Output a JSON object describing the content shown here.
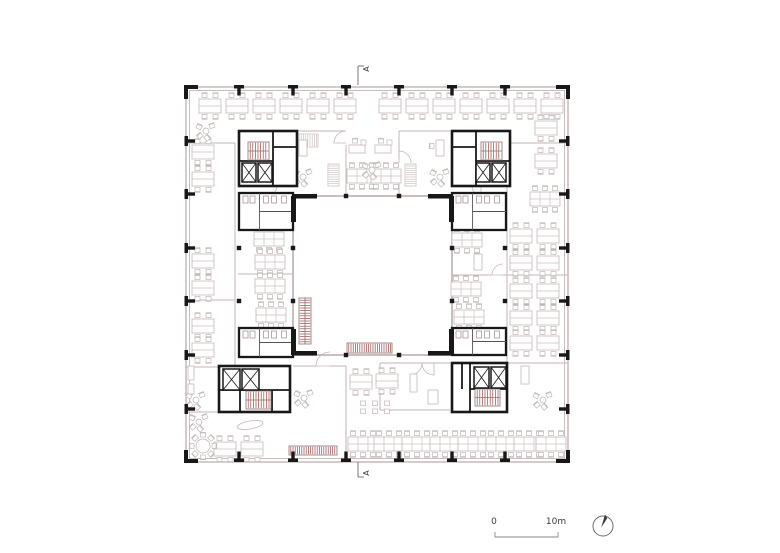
{
  "labels": {
    "section_marker": "A",
    "scale_start": "0",
    "scale_end": "10m"
  },
  "colors": {
    "black": "#181818",
    "wall": "#b3a0a0",
    "wallLight": "#c6b6b6",
    "furn": "#ccc1c1",
    "furn2": "#c3b7b7",
    "red": "#9c4a4a",
    "text": "#3a3a3a",
    "marker": "#6a6a6a"
  },
  "plan": {
    "outer": [
      186,
      87,
      382,
      375
    ],
    "outer_inner": [
      189.5,
      90.5,
      375,
      368
    ],
    "courtyard": [
      293,
      196,
      159,
      159
    ],
    "partitions": [
      [
        186,
        143,
        235,
        143
      ],
      [
        235,
        143,
        235,
        367
      ],
      [
        186,
        300,
        235,
        300
      ],
      [
        186,
        367,
        219,
        367
      ],
      [
        186,
        412,
        219,
        412
      ],
      [
        293,
        366,
        316,
        366
      ],
      [
        330,
        366,
        346,
        366
      ],
      [
        346,
        366,
        346,
        462
      ],
      [
        380,
        363,
        380,
        410
      ],
      [
        380,
        410,
        450,
        410
      ],
      [
        380,
        363,
        450,
        363
      ],
      [
        507,
        186,
        507,
        363
      ],
      [
        507,
        143,
        568,
        143
      ],
      [
        507,
        363,
        568,
        363
      ],
      [
        452,
        275,
        492,
        275
      ],
      [
        503,
        275,
        568,
        275
      ],
      [
        238,
        274,
        293,
        274
      ],
      [
        297,
        131,
        346,
        131
      ],
      [
        346,
        145,
        346,
        196
      ],
      [
        399,
        131,
        450,
        131
      ],
      [
        399,
        131,
        399,
        159
      ],
      [
        399,
        170,
        399,
        196
      ]
    ],
    "doors": [
      [
        346,
        143,
        12,
        180,
        270
      ],
      [
        399,
        163,
        12,
        270,
        360
      ],
      [
        330,
        366,
        14,
        180,
        270
      ],
      [
        503,
        275,
        11,
        180,
        270
      ],
      [
        268,
        186,
        9,
        0,
        90
      ],
      [
        481,
        186,
        9,
        90,
        180
      ],
      [
        410,
        363,
        12,
        0,
        90
      ],
      [
        434,
        363,
        12,
        90,
        180
      ],
      [
        262,
        230,
        8,
        0,
        90
      ],
      [
        475,
        230,
        8,
        90,
        180
      ],
      [
        262,
        328,
        8,
        270,
        360
      ],
      [
        475,
        328,
        8,
        180,
        270
      ]
    ],
    "grid_top_x": [
      239,
      293,
      346,
      399,
      452,
      505
    ],
    "grid_side_y": [
      141,
      194,
      248,
      301,
      355,
      409
    ],
    "courtyard_cols": [
      [
        346,
        196
      ],
      [
        399,
        196
      ],
      [
        346,
        355
      ],
      [
        399,
        355
      ],
      [
        293,
        248
      ],
      [
        293,
        301
      ],
      [
        452,
        248
      ],
      [
        452,
        301
      ]
    ],
    "interior_cols": [
      [
        239,
        248
      ],
      [
        239,
        301
      ],
      [
        505,
        248
      ],
      [
        505,
        301
      ]
    ],
    "stubs": [
      [
        291,
        196,
        5,
        26
      ],
      [
        291,
        329,
        5,
        26
      ],
      [
        449,
        196,
        5,
        26
      ],
      [
        449,
        329,
        5,
        26
      ],
      [
        293,
        194,
        24,
        4.5
      ],
      [
        428,
        194,
        24,
        4.5
      ],
      [
        293,
        351,
        24,
        4.5
      ],
      [
        428,
        351,
        24,
        4.5
      ]
    ],
    "cores": [
      {
        "id": "top-left",
        "rect": [
          239,
          131,
          58,
          55
        ],
        "walls": [
          [
            273,
            131,
            273,
            186
          ],
          [
            239,
            161,
            273,
            161
          ],
          [
            273,
            147,
            297,
            147
          ]
        ],
        "stair": [
          248,
          142,
          21,
          18,
          "v"
        ],
        "lifts": [
          [
            242,
            163,
            14,
            19
          ],
          [
            258,
            163,
            14,
            19
          ]
        ]
      },
      {
        "id": "top-right",
        "rect": [
          452,
          131,
          58,
          55
        ],
        "walls": [
          [
            476,
            131,
            476,
            186
          ],
          [
            476,
            161,
            510,
            161
          ],
          [
            452,
            147,
            476,
            147
          ]
        ],
        "stair": [
          481,
          142,
          21,
          18,
          "v"
        ],
        "lifts": [
          [
            476,
            163,
            14,
            19
          ],
          [
            492,
            163,
            14,
            19
          ]
        ]
      },
      {
        "id": "bottom-left",
        "rect": [
          219,
          366,
          71,
          46
        ],
        "walls": [
          [
            219,
            390,
            290,
            390
          ],
          [
            240,
            390,
            240,
            412
          ],
          [
            272,
            390,
            272,
            412
          ]
        ],
        "stair": [
          246,
          391,
          25,
          18,
          "v"
        ],
        "lifts": [
          [
            223,
            369,
            17,
            21
          ],
          [
            242,
            369,
            17,
            21
          ]
        ]
      },
      {
        "id": "bottom-right",
        "rect": [
          452,
          363,
          55,
          49
        ],
        "walls": [
          [
            470,
            363,
            470,
            412
          ],
          [
            470,
            389,
            507,
            389
          ],
          [
            462,
            363,
            462,
            389
          ]
        ],
        "stair": [
          475,
          389,
          25,
          17,
          "v"
        ],
        "lifts": [
          [
            474,
            367,
            15,
            21
          ],
          [
            491,
            367,
            15,
            21
          ]
        ]
      }
    ],
    "wc_cores": [
      [
        239,
        193,
        54,
        37
      ],
      [
        239,
        328,
        54,
        29
      ],
      [
        452,
        193,
        54,
        37
      ],
      [
        452,
        328,
        54,
        27
      ]
    ],
    "stairs": [
      [
        299,
        298,
        12,
        46,
        "h"
      ]
    ],
    "benches": [
      [
        347,
        343,
        45,
        10
      ],
      [
        289,
        446,
        48,
        9
      ]
    ],
    "shelves": [
      [
        297,
        134,
        21,
        13
      ],
      [
        328,
        164,
        11,
        22
      ],
      [
        405,
        164,
        11,
        22
      ]
    ],
    "misc": [
      [
        410,
        374,
        7,
        18
      ],
      [
        428,
        390,
        10,
        14
      ],
      [
        521,
        366,
        8,
        18
      ],
      [
        188,
        366,
        6,
        14
      ],
      [
        188,
        384,
        6,
        10
      ],
      [
        474,
        254,
        8,
        16
      ]
    ],
    "canoe": [
      250,
      425,
      13,
      4,
      -10
    ],
    "desks": [
      [
        210,
        106,
        "h2"
      ],
      [
        237,
        106,
        "h2"
      ],
      [
        264,
        106,
        "h2"
      ],
      [
        291,
        106,
        "h2"
      ],
      [
        318,
        106,
        "h2"
      ],
      [
        345,
        106,
        "h2"
      ],
      [
        390,
        106,
        "h2"
      ],
      [
        417,
        106,
        "h2"
      ],
      [
        444,
        106,
        "h2"
      ],
      [
        471,
        106,
        "h2"
      ],
      [
        498,
        106,
        "h2"
      ],
      [
        525,
        106,
        "h2"
      ],
      [
        552,
        106,
        "h2"
      ],
      [
        203,
        152,
        "h2"
      ],
      [
        203,
        179,
        "h2"
      ],
      [
        203,
        261,
        "h2"
      ],
      [
        203,
        288,
        "h2"
      ],
      [
        203,
        326,
        "h2"
      ],
      [
        203,
        350,
        "h2"
      ],
      [
        546,
        128,
        "h2"
      ],
      [
        546,
        161,
        "h2"
      ],
      [
        545,
        199,
        "h3"
      ],
      [
        521,
        236,
        "h2"
      ],
      [
        548,
        236,
        "h2"
      ],
      [
        521,
        263,
        "h2"
      ],
      [
        548,
        263,
        "h2"
      ],
      [
        521,
        291,
        "h2"
      ],
      [
        548,
        291,
        "h2"
      ],
      [
        521,
        318,
        "h2"
      ],
      [
        548,
        318,
        "h2"
      ],
      [
        521,
        343,
        "h2"
      ],
      [
        548,
        343,
        "h2"
      ],
      [
        269,
        239,
        "h3"
      ],
      [
        270,
        262,
        "h3"
      ],
      [
        270,
        286,
        "h3"
      ],
      [
        271,
        315,
        "h3"
      ],
      [
        467,
        240,
        "h3"
      ],
      [
        466,
        289,
        "h3"
      ],
      [
        469,
        317,
        "h3"
      ],
      [
        362,
        176,
        "h3"
      ],
      [
        386,
        176,
        "h3"
      ],
      [
        357,
        149,
        "d1"
      ],
      [
        383,
        149,
        "d1"
      ],
      [
        303,
        148,
        "v1"
      ],
      [
        440,
        148,
        "v1"
      ],
      [
        361,
        382,
        "h2"
      ],
      [
        387,
        381,
        "h2"
      ],
      [
        363,
        444,
        "h3"
      ],
      [
        389,
        444,
        "h3"
      ],
      [
        417,
        444,
        "h3"
      ],
      [
        445,
        444,
        "h3"
      ],
      [
        473,
        444,
        "h3"
      ],
      [
        501,
        444,
        "h3"
      ],
      [
        529,
        444,
        "h3"
      ],
      [
        551,
        444,
        "h3"
      ],
      [
        225,
        449,
        "h2"
      ],
      [
        252,
        449,
        "h2"
      ],
      [
        203,
        446,
        "r8"
      ],
      [
        206,
        131,
        "sc"
      ],
      [
        372,
        170,
        "sc"
      ],
      [
        303,
        177,
        "sc"
      ],
      [
        440,
        177,
        "sc"
      ],
      [
        196,
        400,
        "sc"
      ],
      [
        199,
        422,
        "sc"
      ],
      [
        304,
        398,
        "sc"
      ],
      [
        543,
        400,
        "sc"
      ],
      [
        375,
        407,
        "st"
      ]
    ],
    "section_markers": {
      "top": {
        "line": [
          358,
          66,
          358,
          85
        ],
        "tick": [
          358,
          66,
          364,
          66
        ],
        "label_xy": [
          369,
          69
        ]
      },
      "bottom": {
        "line": [
          358,
          462,
          358,
          477
        ],
        "tick": [
          358,
          477,
          364,
          477
        ],
        "label_xy": [
          369,
          473
        ]
      }
    },
    "scalebar": {
      "zero_xy": [
        494,
        524
      ],
      "ten_xy": [
        556,
        524
      ],
      "bracket": [
        495,
        537,
        558,
        537
      ],
      "tick_h": 5
    },
    "north": {
      "cx": 603,
      "cy": 526,
      "r": 10,
      "needle": [
        [
          601.2,
          527.5
        ],
        [
          605.0,
          514.5
        ],
        [
          607.2,
          518.2
        ]
      ]
    }
  }
}
